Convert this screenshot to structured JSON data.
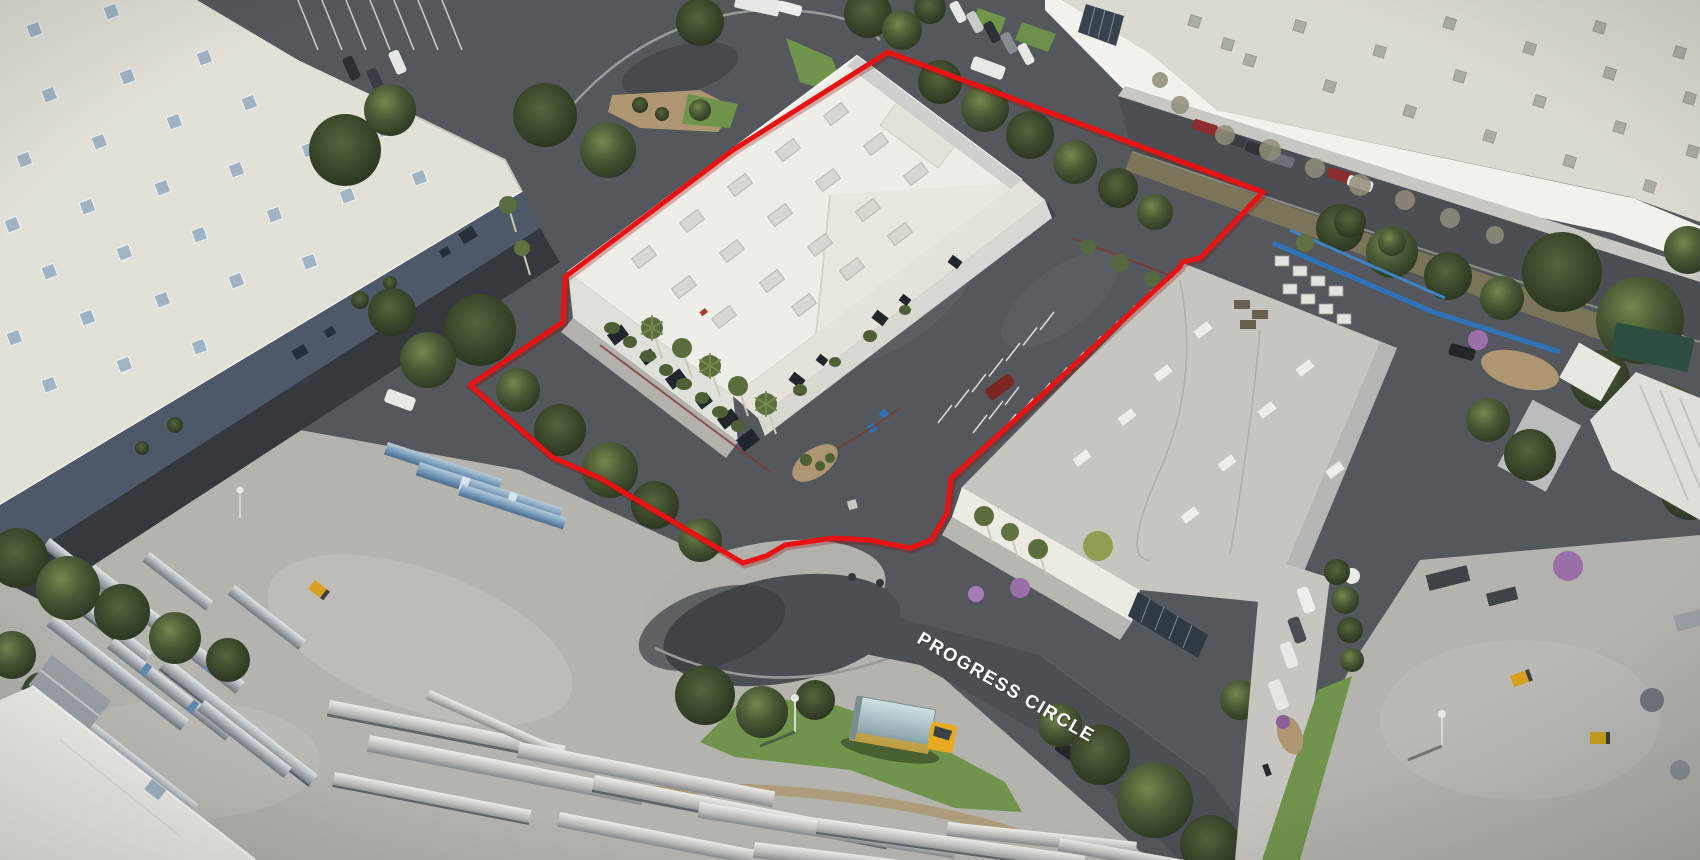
{
  "scene": {
    "kind": "oblique-aerial-photograph",
    "subject": "industrial park parcel outlined in red at end of cul-de-sac"
  },
  "street_label": {
    "text": "PROGRESS CIRCLE",
    "color": "#ffffff",
    "rotation_deg": 30
  },
  "property_outline": {
    "color": "#e81212",
    "underlay_color": "#8f0d0d",
    "stroke_width": 5
  },
  "palette": {
    "asphalt": "#54575b",
    "asphalt_shadow": "#35393e",
    "road": "#4b4f54",
    "concrete": "#b4b3ad",
    "concrete_aisle": "#c6c5bf",
    "roof_white": "#eeede7",
    "roof_white_annex": "#e4e2da",
    "roof_beige": "#e3e0d7",
    "roof_gray": "#c6c6c1",
    "roof_topright": "#dcd9d0",
    "wall_dark": "#4d5868",
    "wall_white": "#f2f1ec",
    "skylight_blue": "#9fb3c2",
    "lawn": "#71944c",
    "dirt": "#ad9671",
    "truck_yellow": "#e8ab1f",
    "truck_box_top": "#c9dcdc",
    "rack_blue": "#2f72b8",
    "bougainvillea": "#9b6fa8",
    "curb_red": "#7e3b32",
    "stripe_white": "#f2f2ee"
  }
}
